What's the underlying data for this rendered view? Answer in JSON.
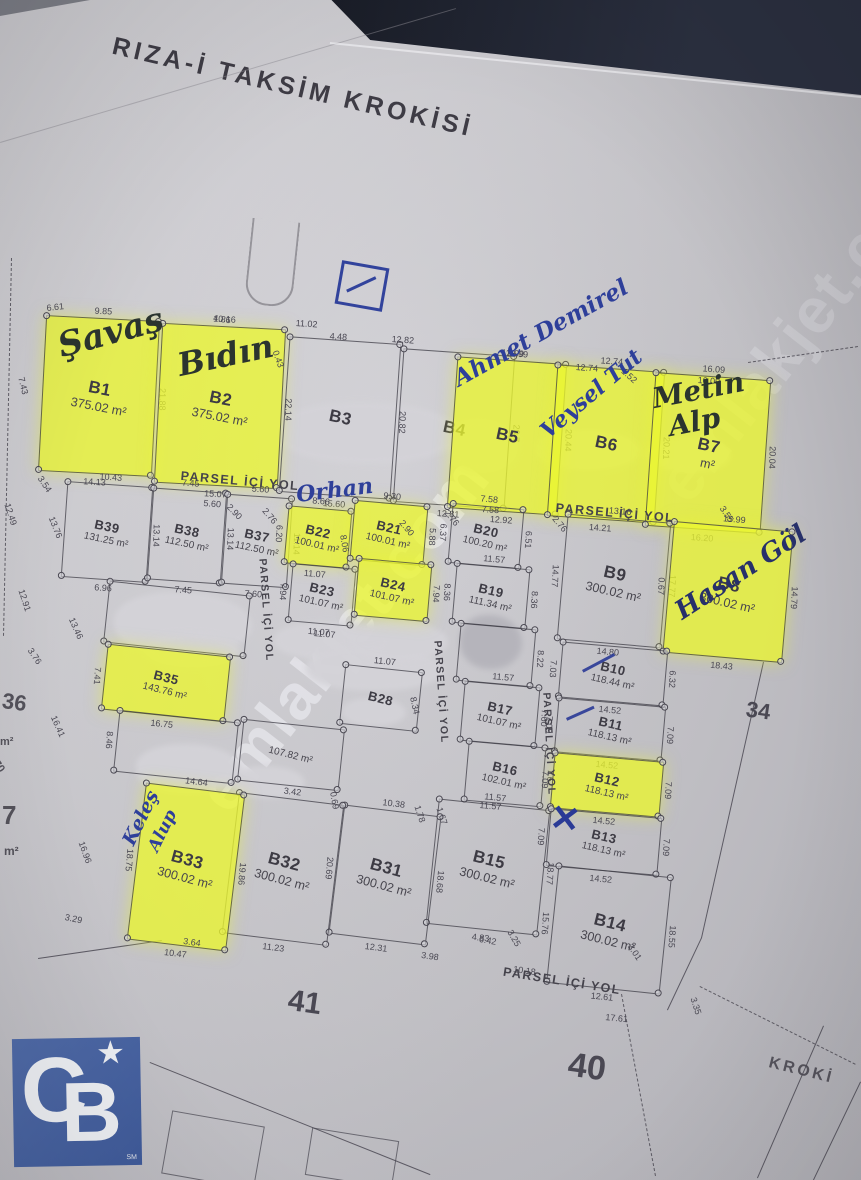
{
  "title": "RIZA-İ TAKSİM KROKİSİ",
  "watermark": "emlakjet.com",
  "corner_text": "KROKİ",
  "road_label": "PARSEL İÇİ YOL",
  "block_numbers": {
    "left": "41",
    "center": "40",
    "right": "34"
  },
  "logo": {
    "letter_c": "C",
    "letter_b": "B",
    "star": "★",
    "sm": "SM",
    "color": "#46619e"
  },
  "colors": {
    "paper": "#c9c8cd",
    "ink": "#3e3c45",
    "highlight": "#ebf630",
    "blue_ink": "#2c3b94",
    "marker": "#2b342f",
    "logo_blue": "#46619e"
  },
  "parcels": [
    {
      "id": "B1",
      "area": "375.02 m²",
      "hl": true,
      "x": 42,
      "y": 318,
      "w": 114,
      "h": 156,
      "rot": 3,
      "dims": {
        "top": "9.85",
        "bottom": "14.13",
        "right": "21.88"
      }
    },
    {
      "id": "B2",
      "area": "375.02 m²",
      "hl": true,
      "x": 158,
      "y": 326,
      "w": 124,
      "h": 160,
      "rot": 3,
      "dims": {
        "top": "10.16",
        "bottom": "15.07",
        "right": "22.14"
      }
    },
    {
      "id": "B3",
      "area": "",
      "hl": false,
      "x": 284,
      "y": 340,
      "w": 112,
      "h": 156,
      "rot": 4,
      "dims": {
        "bottom": "15.60",
        "right": "20.82"
      }
    },
    {
      "id": "B4",
      "area": "",
      "hl": false,
      "x": 398,
      "y": 352,
      "w": 112,
      "h": 154,
      "rot": 4,
      "dims": {
        "bottom": "12.81",
        "right": "20.7"
      }
    },
    {
      "id": "B5",
      "area": "",
      "hl": true,
      "x": 452,
      "y": 360,
      "w": 110,
      "h": 152,
      "rot": 4,
      "dims": {
        "top": "12.99",
        "bottom": "12.92",
        "right": "20.44"
      }
    },
    {
      "id": "B6",
      "area": "",
      "hl": true,
      "x": 552,
      "y": 368,
      "w": 108,
      "h": 152,
      "rot": 4,
      "dims": {
        "top": "12.74",
        "bottom": "14.21",
        "right": "20.21"
      }
    },
    {
      "id": "B7",
      "area": "m²",
      "hl": true,
      "x": 650,
      "y": 376,
      "w": 116,
      "h": 154,
      "rot": 4,
      "dims": {
        "top": "16.09",
        "bottom": "16.20",
        "right": "20.04"
      }
    },
    {
      "id": "B39",
      "area": "131.25 m²",
      "hl": false,
      "x": 64,
      "y": 484,
      "w": 86,
      "h": 96,
      "rot": 4,
      "dims": {
        "top": "10.43",
        "bottom": "6.96",
        "right": "13.14"
      }
    },
    {
      "id": "B38",
      "area": "112.50 m²",
      "hl": false,
      "x": 150,
      "y": 490,
      "w": 74,
      "h": 92,
      "rot": 4,
      "dims": {
        "top": "7.45",
        "bottom": "7.45",
        "right": "13.14"
      }
    },
    {
      "id": "B37",
      "area": "112.50 m²",
      "hl": false,
      "x": 224,
      "y": 496,
      "w": 66,
      "h": 90,
      "rot": 4,
      "dims": {
        "top": "5.60",
        "bottom": "7.60",
        "right": "11.14"
      }
    },
    {
      "id": "B22",
      "area": "100.01 m²",
      "hl": true,
      "x": 286,
      "y": 508,
      "w": 64,
      "h": 58,
      "rot": 5,
      "dims": {
        "top": "8.66",
        "bottom": "11.07",
        "left": "6.20"
      }
    },
    {
      "id": "B21",
      "area": "100.01 m²",
      "hl": true,
      "x": 352,
      "y": 503,
      "w": 74,
      "h": 60,
      "rot": 5,
      "dims": {
        "top": "9.30",
        "right": "5.88"
      }
    },
    {
      "id": "B23",
      "area": "101.07 m²",
      "hl": false,
      "x": 290,
      "y": 566,
      "w": 64,
      "h": 58,
      "rot": 5,
      "dims": {
        "bottom": "11.07",
        "left": "7.94"
      }
    },
    {
      "id": "B24",
      "area": "101.07 m²",
      "hl": true,
      "x": 356,
      "y": 561,
      "w": 74,
      "h": 58,
      "rot": 5,
      "dims": {
        "right": "7.94"
      }
    },
    {
      "id": "B20",
      "area": "100.20 m²",
      "hl": false,
      "x": 450,
      "y": 506,
      "w": 72,
      "h": 60,
      "rot": 5,
      "dims": {
        "top": "7.58",
        "left": "6.37",
        "right": "6.51"
      }
    },
    {
      "id": "B19",
      "area": "111.34 m²",
      "hl": false,
      "x": 454,
      "y": 566,
      "w": 74,
      "h": 60,
      "rot": 5,
      "dims": {
        "top": "11.57",
        "left": "8.36",
        "right": "8.36"
      }
    },
    {
      "id": "",
      "area": "",
      "hl": false,
      "x": 458,
      "y": 626,
      "w": 76,
      "h": 58,
      "rot": 5,
      "dims": {
        "right": "8.22"
      }
    },
    {
      "id": "B17",
      "area": "101.07 m²",
      "hl": false,
      "x": 462,
      "y": 684,
      "w": 76,
      "h": 60,
      "rot": 5,
      "dims": {
        "top": "11.57",
        "right": "7.60"
      }
    },
    {
      "id": "B16",
      "area": "102.01 m²",
      "hl": false,
      "x": 466,
      "y": 744,
      "w": 78,
      "h": 60,
      "rot": 5,
      "dims": {
        "right": "7.67"
      }
    },
    {
      "id": "B15",
      "area": "300.02 m²",
      "hl": false,
      "x": 432,
      "y": 804,
      "w": 112,
      "h": 126,
      "rot": 6,
      "dims": {
        "top": "11.57",
        "bottom": "4.83",
        "right": "18.77"
      }
    },
    {
      "id": "B9",
      "area": "300.02 m²",
      "hl": false,
      "x": 562,
      "y": 518,
      "w": 104,
      "h": 126,
      "rot": 5,
      "dims": {
        "top": "13.16",
        "bottom": "14.80",
        "left": "14.77",
        "right": "17.77"
      }
    },
    {
      "id": "B8",
      "area": "300.02 m²",
      "hl": true,
      "x": 668,
      "y": 526,
      "w": 120,
      "h": 132,
      "rot": 5,
      "dims": {
        "top": "15.99",
        "bottom": "18.43",
        "left": "0.67",
        "right": "14.79"
      }
    },
    {
      "id": "B10",
      "area": "118.44 m²",
      "hl": false,
      "x": 560,
      "y": 646,
      "w": 106,
      "h": 56,
      "rot": 5,
      "dims": {
        "bottom": "14.52",
        "left": "7.03",
        "right": "6.32"
      }
    },
    {
      "id": "B11",
      "area": "118.13 m²",
      "hl": false,
      "x": 556,
      "y": 702,
      "w": 108,
      "h": 55,
      "rot": 5,
      "dims": {
        "bottom": "14.52",
        "left": "7.09",
        "right": "7.09"
      }
    },
    {
      "id": "B12",
      "area": "118.13 m²",
      "hl": true,
      "x": 552,
      "y": 757,
      "w": 110,
      "h": 56,
      "rot": 5,
      "dims": {
        "bottom": "14.52",
        "left": "7.09",
        "right": "7.09"
      }
    },
    {
      "id": "B13",
      "area": "118.13 m²",
      "hl": false,
      "x": 548,
      "y": 813,
      "w": 112,
      "h": 58,
      "rot": 5,
      "dims": {
        "bottom": "14.52",
        "left": "7.09",
        "right": "7.09"
      }
    },
    {
      "id": "B14",
      "area": "300.02 m²",
      "hl": false,
      "x": 552,
      "y": 871,
      "w": 114,
      "h": 118,
      "rot": 6,
      "dims": {
        "bottom": "12.61",
        "left": "15.76",
        "right": "18.55"
      }
    },
    {
      "id": "B31",
      "area": "300.02 m²",
      "hl": false,
      "x": 336,
      "y": 810,
      "w": 98,
      "h": 130,
      "rot": 7,
      "dims": {
        "top": "10.38",
        "bottom": "12.31",
        "left": "20.69",
        "right": "18.68"
      }
    },
    {
      "id": "B32",
      "area": "300.02 m²",
      "hl": false,
      "x": 230,
      "y": 798,
      "w": 106,
      "h": 142,
      "rot": 7,
      "dims": {
        "top": "3.42",
        "bottom": "11.23"
      }
    },
    {
      "id": "B33",
      "area": "300.02 m²",
      "hl": true,
      "x": 136,
      "y": 788,
      "w": 100,
      "h": 158,
      "rot": 7,
      "dims": {
        "top": "14.64",
        "bottom": "10.47",
        "left": "18.75",
        "right": "19.86"
      }
    },
    {
      "id": "",
      "area": "",
      "hl": false,
      "x": 106,
      "y": 588,
      "w": 142,
      "h": 62,
      "rot": 6,
      "dims": {}
    },
    {
      "id": "B35",
      "area": "143.76 m²",
      "hl": true,
      "x": 104,
      "y": 650,
      "w": 124,
      "h": 66,
      "rot": 6,
      "dims": {
        "bottom": "16.75",
        "left": "7.41"
      }
    },
    {
      "id": "",
      "area": "",
      "hl": false,
      "x": 116,
      "y": 716,
      "w": 120,
      "h": 62,
      "rot": 6,
      "dims": {
        "left": "8.46"
      }
    },
    {
      "id": "",
      "area": "107.82 m²",
      "hl": false,
      "x": 240,
      "y": 724,
      "w": 102,
      "h": 62,
      "rot": 6,
      "dims": {}
    },
    {
      "id": "B28",
      "area": "",
      "hl": false,
      "x": 342,
      "y": 668,
      "w": 78,
      "h": 60,
      "rot": 6,
      "dims": {
        "top": "11.07"
      }
    }
  ],
  "loose_dims": [
    {
      "t": "6.61",
      "x": 46,
      "y": 303,
      "r": -6
    },
    {
      "t": "11.02",
      "x": 296,
      "y": 318,
      "r": 4
    },
    {
      "t": "4.48",
      "x": 330,
      "y": 331,
      "r": 4
    },
    {
      "t": "4.86",
      "x": 214,
      "y": 313,
      "r": 8
    },
    {
      "t": "0.43",
      "x": 280,
      "y": 349,
      "r": 70
    },
    {
      "t": "12.82",
      "x": 392,
      "y": 334,
      "r": 4
    },
    {
      "t": "12.99",
      "x": 506,
      "y": 348,
      "r": 4
    },
    {
      "t": "12.74",
      "x": 576,
      "y": 362,
      "r": 4
    },
    {
      "t": "1.52",
      "x": 626,
      "y": 366,
      "r": 42
    },
    {
      "t": "16.09",
      "x": 698,
      "y": 375,
      "r": 4
    },
    {
      "t": "7.43",
      "x": 26,
      "y": 376,
      "r": 76
    },
    {
      "t": "3.54",
      "x": 44,
      "y": 474,
      "r": 56
    },
    {
      "t": "12.49",
      "x": 12,
      "y": 502,
      "r": 72
    },
    {
      "t": "13.76",
      "x": 56,
      "y": 515,
      "r": 68
    },
    {
      "t": "12.91",
      "x": 26,
      "y": 588,
      "r": 72
    },
    {
      "t": "13.46",
      "x": 76,
      "y": 616,
      "r": 66
    },
    {
      "t": "3.76",
      "x": 34,
      "y": 646,
      "r": 56
    },
    {
      "t": "16.41",
      "x": 58,
      "y": 714,
      "r": 66
    },
    {
      "t": "16.96",
      "x": 86,
      "y": 840,
      "r": 70
    },
    {
      "t": "3.29",
      "x": 66,
      "y": 912,
      "r": 12
    },
    {
      "t": "2.76",
      "x": 268,
      "y": 506,
      "r": 50
    },
    {
      "t": "5.60",
      "x": 204,
      "y": 498,
      "r": 5
    },
    {
      "t": "2.90",
      "x": 232,
      "y": 502,
      "r": 46
    },
    {
      "t": "8.06",
      "x": 348,
      "y": 534,
      "r": 80
    },
    {
      "t": "2.90",
      "x": 405,
      "y": 518,
      "r": 50
    },
    {
      "t": "2.76",
      "x": 450,
      "y": 508,
      "r": 50
    },
    {
      "t": "7.58",
      "x": 482,
      "y": 504,
      "r": 4
    },
    {
      "t": "2.76",
      "x": 558,
      "y": 514,
      "r": 50
    },
    {
      "t": "8.34",
      "x": 418,
      "y": 696,
      "r": 78
    },
    {
      "t": "3.55",
      "x": 726,
      "y": 504,
      "r": 56
    },
    {
      "t": "1.78",
      "x": 422,
      "y": 804,
      "r": 72
    },
    {
      "t": "1.67",
      "x": 444,
      "y": 806,
      "r": 72
    },
    {
      "t": "0.69",
      "x": 338,
      "y": 791,
      "r": 80
    },
    {
      "t": "6.42",
      "x": 480,
      "y": 934,
      "r": 10
    },
    {
      "t": "3.25",
      "x": 514,
      "y": 928,
      "r": 60
    },
    {
      "t": "3.98",
      "x": 422,
      "y": 950,
      "r": 8
    },
    {
      "t": "10.18",
      "x": 514,
      "y": 964,
      "r": 8
    },
    {
      "t": "3.01",
      "x": 634,
      "y": 942,
      "r": 56
    },
    {
      "t": "3.35",
      "x": 698,
      "y": 996,
      "r": 72
    },
    {
      "t": "17.61",
      "x": 606,
      "y": 1012,
      "r": 6
    },
    {
      "t": "3.64",
      "x": 184,
      "y": 936,
      "r": 8
    },
    {
      "t": "11.07",
      "x": 314,
      "y": 628,
      "r": 5
    },
    {
      "t": "11.57",
      "x": 480,
      "y": 800,
      "r": 5
    }
  ],
  "handwriting": [
    {
      "t": "Şavaş",
      "x": 64,
      "y": 360,
      "r": -15,
      "s": 34,
      "c": "#2b342f"
    },
    {
      "t": "Bıdın",
      "x": 182,
      "y": 378,
      "r": -12,
      "s": 32,
      "c": "#2b342f"
    },
    {
      "t": "Ahmet Demirel",
      "x": 462,
      "y": 388,
      "r": -29,
      "s": 23,
      "c": "#2e3f9a"
    },
    {
      "t": "Veysel Tut",
      "x": 552,
      "y": 440,
      "r": -40,
      "s": 22,
      "c": "#2e3f9a"
    },
    {
      "t": "Metin",
      "x": 656,
      "y": 410,
      "r": -11,
      "s": 28,
      "c": "#2b342f"
    },
    {
      "t": "Alp",
      "x": 672,
      "y": 438,
      "r": -11,
      "s": 28,
      "c": "#2b342f"
    },
    {
      "t": "Hasan Göl",
      "x": 686,
      "y": 622,
      "r": -33,
      "s": 26,
      "c": "#27306a"
    },
    {
      "t": "Keleş",
      "x": 138,
      "y": 846,
      "r": -64,
      "s": 19,
      "c": "#2e3f9a"
    },
    {
      "t": "Alup",
      "x": 162,
      "y": 852,
      "r": -64,
      "s": 17,
      "c": "#2e3f9a"
    },
    {
      "t": "Orhan",
      "x": 298,
      "y": 504,
      "r": -7,
      "s": 22,
      "c": "#2e3f9a"
    }
  ],
  "roads": [
    {
      "x": 240,
      "y": 481,
      "r": 5
    },
    {
      "x": 615,
      "y": 513,
      "r": 5
    },
    {
      "x": 266,
      "y": 610,
      "r": 86
    },
    {
      "x": 441,
      "y": 692,
      "r": 86
    },
    {
      "x": 549,
      "y": 744,
      "r": 87
    },
    {
      "x": 562,
      "y": 981,
      "r": 9
    }
  ],
  "redactions": [
    {
      "x": 276,
      "y": 402,
      "w": 184,
      "h": 62
    },
    {
      "x": 448,
      "y": 420,
      "w": 70,
      "h": 52
    },
    {
      "x": 536,
      "y": 430,
      "w": 104,
      "h": 40
    },
    {
      "x": 648,
      "y": 438,
      "w": 82,
      "h": 34
    },
    {
      "x": 114,
      "y": 592,
      "w": 138,
      "h": 64
    },
    {
      "x": 146,
      "y": 633,
      "w": 94,
      "h": 34
    },
    {
      "x": 274,
      "y": 622,
      "w": 118,
      "h": 38
    },
    {
      "x": 306,
      "y": 647,
      "w": 138,
      "h": 44
    },
    {
      "x": 460,
      "y": 615,
      "w": 62,
      "h": 54,
      "gray": true
    },
    {
      "x": 136,
      "y": 744,
      "w": 106,
      "h": 50
    },
    {
      "x": 231,
      "y": 766,
      "w": 74,
      "h": 32
    },
    {
      "x": 350,
      "y": 621,
      "w": 98,
      "h": 40
    },
    {
      "x": 342,
      "y": 698,
      "w": 64,
      "h": 28
    }
  ],
  "lines": [
    {
      "x1": 748,
      "y1": 362,
      "x2": 858,
      "y2": 346,
      "cls": "dash"
    },
    {
      "x1": 700,
      "y1": 986,
      "x2": 856,
      "y2": 1064,
      "cls": "dash"
    },
    {
      "x1": 622,
      "y1": 994,
      "x2": 656,
      "y2": 1176,
      "cls": "dash"
    },
    {
      "x1": 12,
      "y1": 258,
      "x2": 4,
      "y2": 636,
      "cls": "dash"
    },
    {
      "x1": 150,
      "y1": 1062,
      "x2": 430,
      "y2": 1174,
      "cls": "solid"
    },
    {
      "x1": 38,
      "y1": 958,
      "x2": 162,
      "y2": 940,
      "cls": "solid"
    },
    {
      "x1": 764,
      "y1": 662,
      "x2": 702,
      "y2": 938,
      "cls": "solid"
    },
    {
      "x1": 702,
      "y1": 938,
      "x2": 668,
      "y2": 1010,
      "cls": "solid"
    },
    {
      "x1": 824,
      "y1": 1026,
      "x2": 758,
      "y2": 1178,
      "cls": "solid"
    },
    {
      "x1": 861,
      "y1": 1082,
      "x2": 814,
      "y2": 1180,
      "cls": "solid"
    },
    {
      "x1": 0,
      "y1": 142,
      "x2": 456,
      "y2": 8,
      "cls": "crease"
    },
    {
      "x1": 330,
      "y1": 42,
      "x2": 861,
      "y2": 96,
      "cls": "edge"
    }
  ],
  "edge_fragments": [
    {
      "t": "36",
      "x": 4,
      "y": 688,
      "s": 22,
      "r": 8
    },
    {
      "t": "m²",
      "x": 0,
      "y": 736,
      "s": 11,
      "r": 0
    },
    {
      "t": "70",
      "x": 0,
      "y": 758,
      "s": 11,
      "r": 55
    },
    {
      "t": "7",
      "x": 2,
      "y": 800,
      "s": 26,
      "r": 0
    },
    {
      "t": "m²",
      "x": 4,
      "y": 844,
      "s": 12,
      "r": 0
    }
  ],
  "partial_rects": [
    {
      "x": 166,
      "y": 1118,
      "w": 92,
      "h": 62,
      "r": 10
    },
    {
      "x": 308,
      "y": 1134,
      "w": 86,
      "h": 46,
      "r": 9
    }
  ],
  "annotations": {
    "strokes": [
      {
        "x": 582,
        "y": 670,
        "len": 36,
        "r": -28
      },
      {
        "x": 566,
        "y": 718,
        "len": 30,
        "r": -24
      }
    ],
    "x_mark": {
      "t": "✕",
      "x": 550,
      "y": 798,
      "s": 36
    }
  }
}
